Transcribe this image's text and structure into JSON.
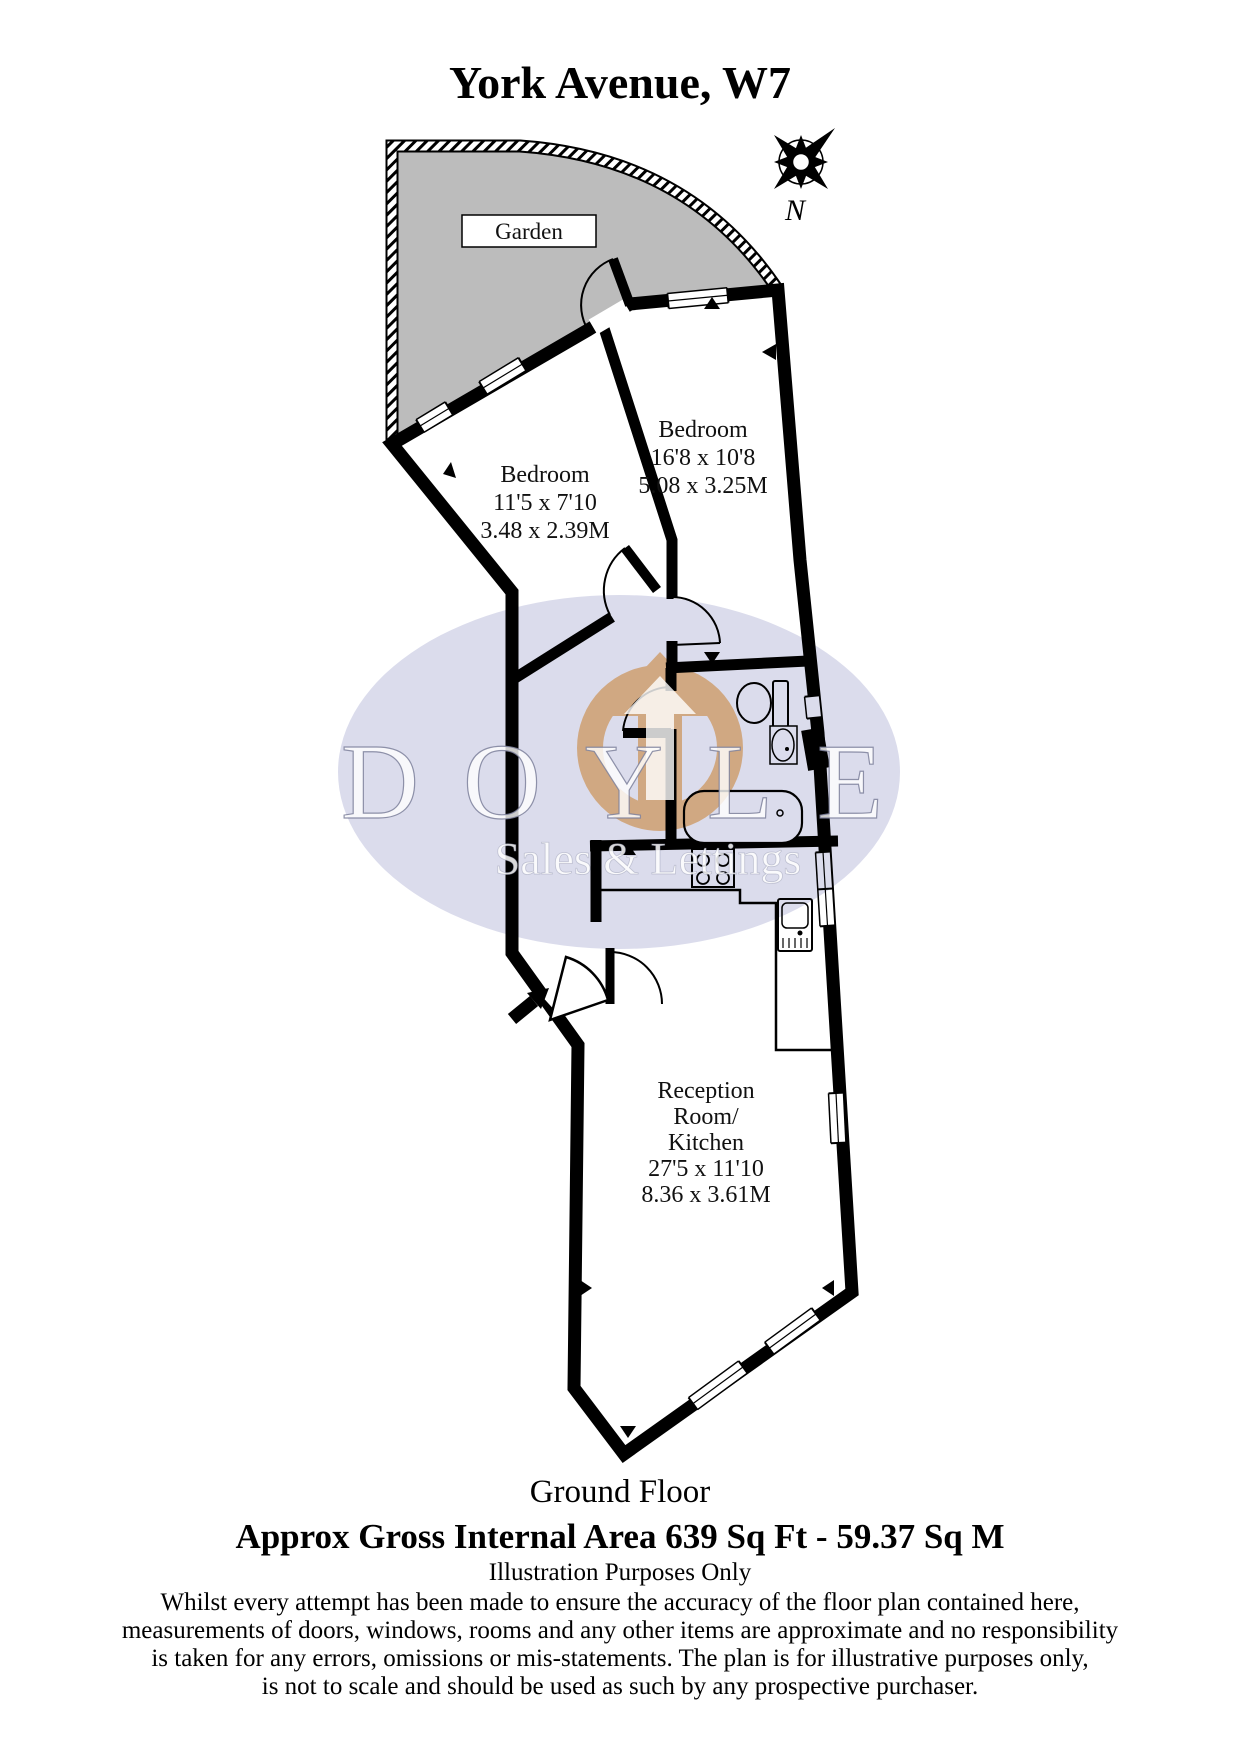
{
  "title": "York Avenue, W7",
  "compass": {
    "label": "N"
  },
  "garden": {
    "label": "Garden"
  },
  "watermark": {
    "brand": "DOYLE",
    "tagline": "Sales & Lettings"
  },
  "rooms": {
    "bedroom1": {
      "name": "Bedroom",
      "imperial": "16'8 x 10'8",
      "metric": "5.08 x 3.25M"
    },
    "bedroom2": {
      "name": "Bedroom",
      "imperial": "11'5 x 7'10",
      "metric": "3.48 x 2.39M"
    },
    "reception": {
      "line1": "Reception",
      "line2": "Room/",
      "line3": "Kitchen",
      "imperial": "27'5 x 11'10",
      "metric": "8.36 x 3.61M"
    }
  },
  "footer": {
    "floor": "Ground Floor",
    "area": "Approx Gross Internal Area  639 Sq Ft  - 59.37 Sq M",
    "note": "Illustration Purposes Only",
    "disclaimer1": "Whilst every attempt has been made to ensure the accuracy of the floor plan contained here,",
    "disclaimer2": "measurements of doors, windows, rooms and any other items are approximate and no responsibility",
    "disclaimer3": "is taken for any errors, omissions or mis-statements. The plan is for illustrative purposes only,",
    "disclaimer4": "is not to scale and should be used as such by any prospective purchaser."
  },
  "colors": {
    "wall": "#000000",
    "garden_fill": "#bcbcbc",
    "watermark_ellipse": "#dbdcec",
    "logo_orange": "#f2bd80"
  },
  "icons": [
    "compass-rose-icon",
    "entry-arrow-icon",
    "toilet-icon",
    "sink-icon",
    "bath-icon",
    "hob-icon"
  ]
}
